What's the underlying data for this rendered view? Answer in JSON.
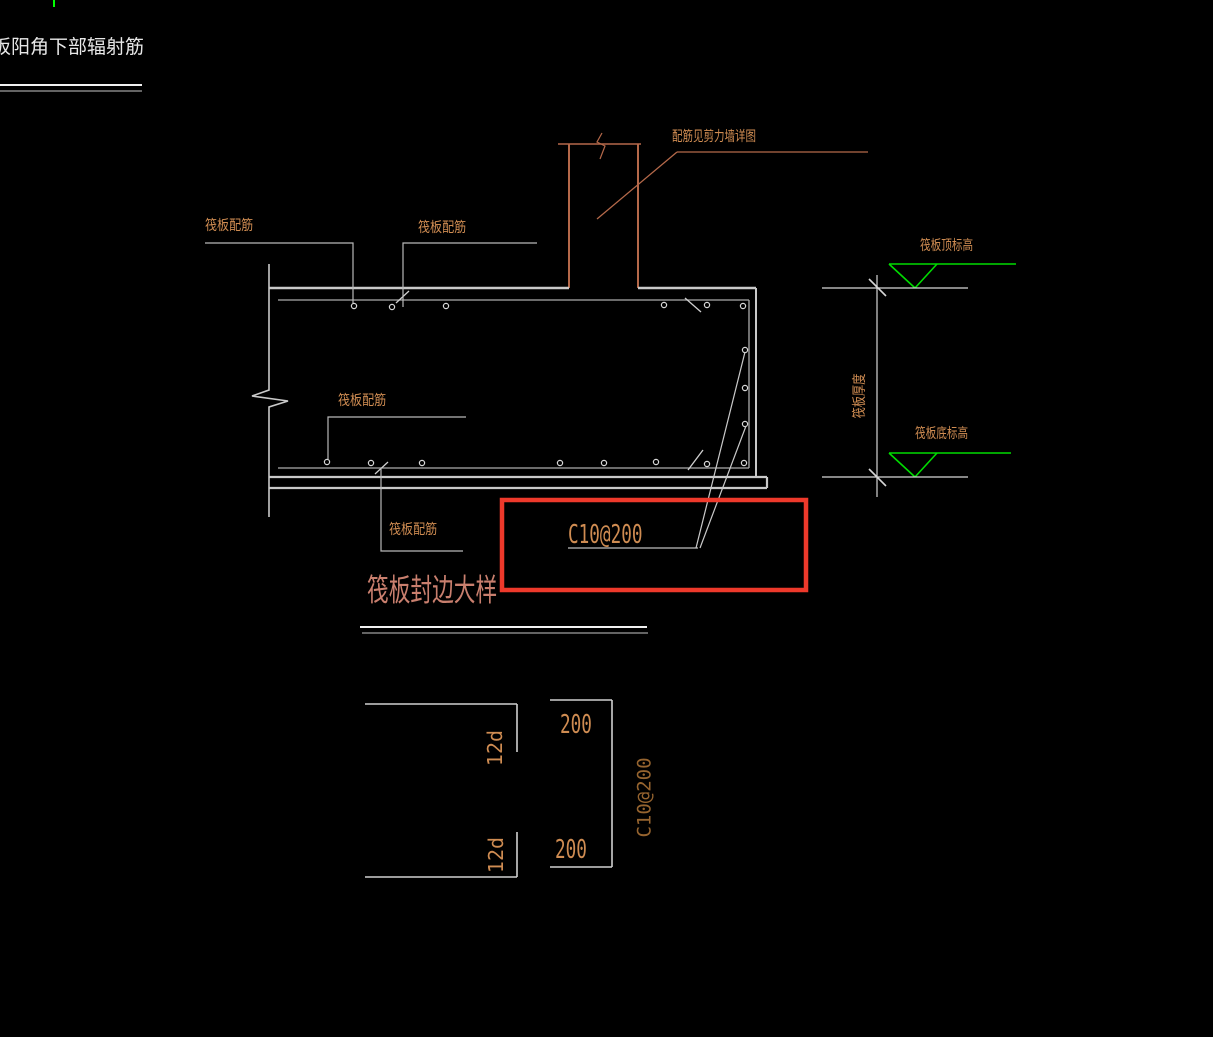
{
  "colors": {
    "background": "#000000",
    "line_white": "#d6d6d6",
    "line_gray": "#9e9e9e",
    "cad_orange": "#cf8c52",
    "cad_salmon": "#b5694a",
    "title_salmon": "#c97f6e",
    "green_marker": "#00dc00",
    "green_tick": "#00ff00",
    "red_highlight": "#ee392b",
    "dark_tan": "#96642f",
    "white_text": "#e8e8e8"
  },
  "corner_title": "筏板阳角下部辐射筋",
  "main_detail": {
    "wall_note": "配筋见剪力墙详图",
    "raft_rebar_label": "筏板配筋",
    "edge_bar_spec": "C10@200",
    "title": "筏板封边大样"
  },
  "elevation": {
    "top_label": "筏板顶标高",
    "bottom_label": "筏板底标高",
    "thickness_label": "筏板厚度"
  },
  "bar_detail": {
    "hook_length": "12d",
    "spacing": "200",
    "bar_spec": "C10@200"
  }
}
